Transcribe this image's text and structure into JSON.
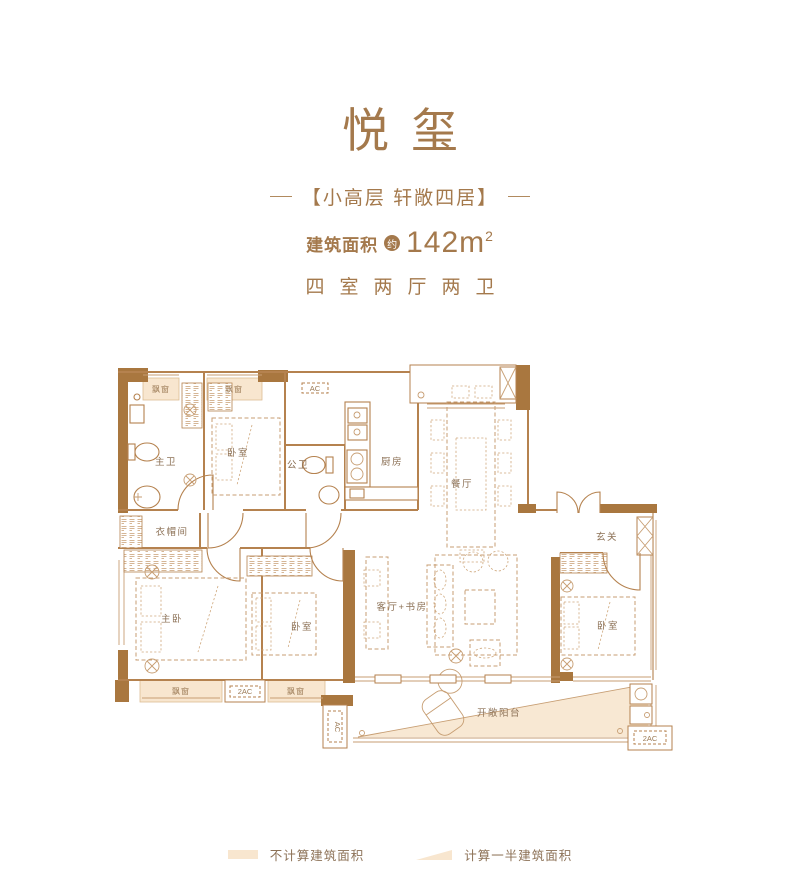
{
  "header": {
    "title": "悦玺",
    "subtitle": "【小高层 轩敞四居】",
    "area_label": "建筑面积",
    "area_qualifier": "约",
    "area_value": "142m",
    "area_exponent": "2",
    "layout_text": "四室两厅两卫"
  },
  "plan": {
    "rooms": {
      "master_bath": "主卫",
      "bedroom_top": "卧室",
      "public_bath": "公卫",
      "kitchen": "厨房",
      "dining": "餐厅",
      "foyer": "玄关",
      "cloakroom": "衣帽间",
      "master_bedroom": "主卧",
      "bedroom_mid": "卧室",
      "living_study": "客厅+书房",
      "bedroom_right": "卧室",
      "balcony": "开敞阳台"
    },
    "labels": {
      "bay_window": "飘窗",
      "ac": "AC",
      "ac2": "2AC"
    }
  },
  "legend": {
    "items": [
      {
        "label": "不计算建筑面积"
      },
      {
        "label": "计算一半建筑面积"
      }
    ]
  },
  "colors": {
    "bronze_text": "#a4794c",
    "wall_brown": "#a9773f",
    "thin_line": "#b5824f",
    "furniture_line": "#c79e73",
    "area_peach": "#f8e6cf",
    "label_gray_brown": "#8c7156"
  }
}
